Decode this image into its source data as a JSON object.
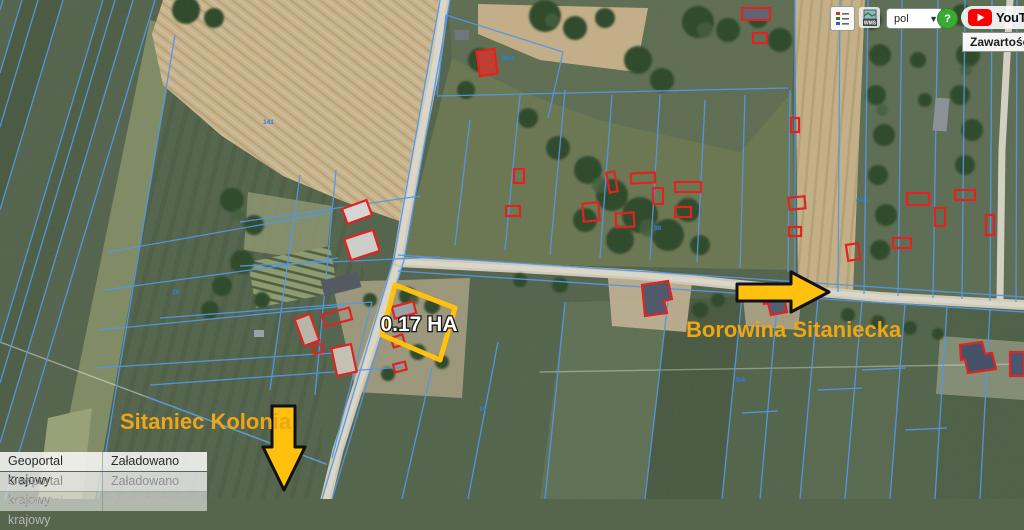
{
  "app": {
    "name": "Geoportal krajowy"
  },
  "toolbar": {
    "legend_button": {
      "icon": "legend-icon"
    },
    "wms_button": {
      "icon": "wms-icon",
      "text": "WMS"
    },
    "language_select": {
      "value": "pol"
    },
    "help_button": {
      "label": "?"
    },
    "youtube_button": {
      "label": "YouTube",
      "icon": "youtube-play-icon"
    }
  },
  "tooltip": {
    "text": "Zawartość m"
  },
  "status_table": {
    "rows": [
      {
        "source": "Geoportal krajowy",
        "status": "Załadowano"
      },
      {
        "source": "Geoportal krajowy",
        "status": "Załadowano"
      },
      {
        "source": "Geoportal krajowy",
        "status": "Załadowano"
      }
    ]
  },
  "annotations": {
    "area_label": "0.17 HA",
    "place_label_right": "Borowina Sitaniecka",
    "place_label_left": "Sitaniec Kolonia",
    "highlight_color": "#FFC10D",
    "label_color": "#EFA616"
  },
  "map": {
    "parcel_line_color": "#4D96E8",
    "building_outline_color": "#E21B1B",
    "parcel_labels": [
      {
        "text": "96/1"
      },
      {
        "text": "141"
      },
      {
        "text": "98"
      },
      {
        "text": "26"
      },
      {
        "text": "14"
      },
      {
        "text": "5/4"
      },
      {
        "text": "84/1"
      }
    ]
  }
}
